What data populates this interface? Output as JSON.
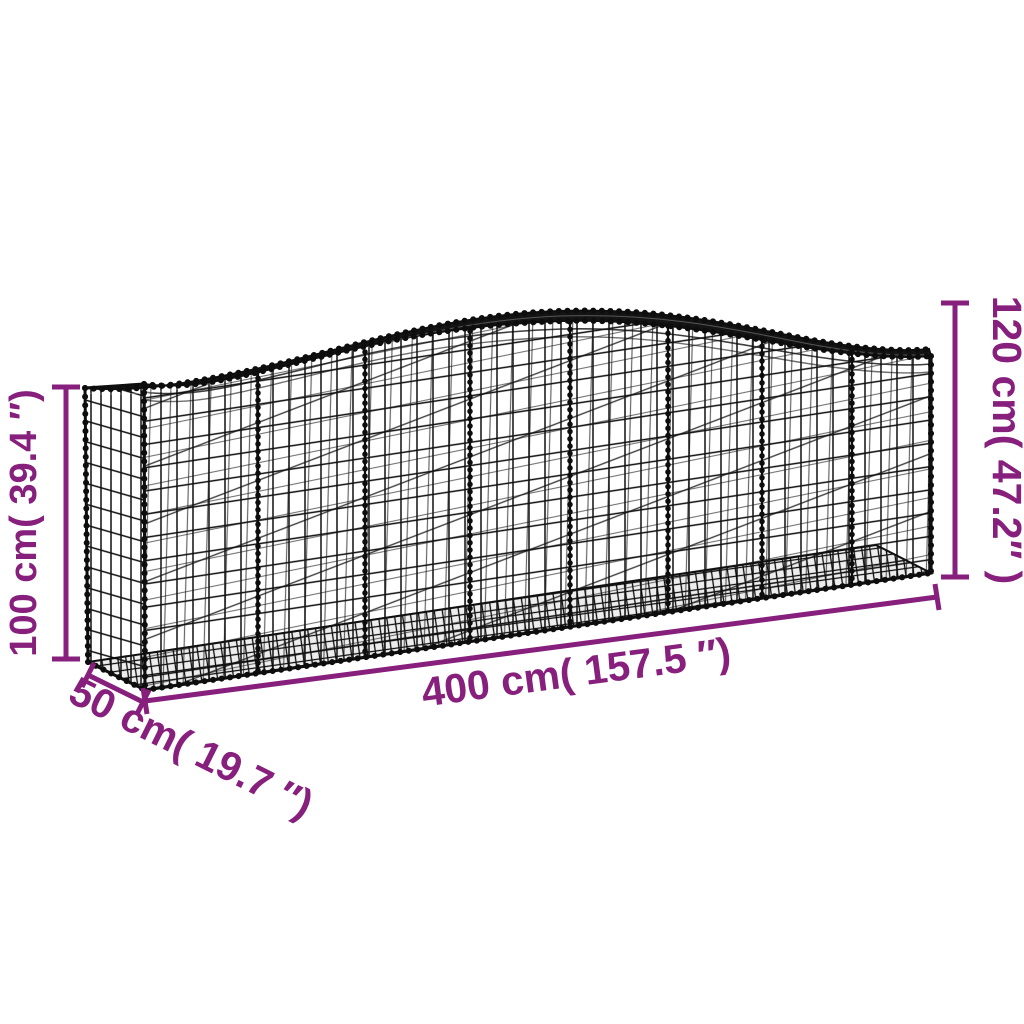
{
  "diagram": {
    "title": "Arched gabion basket dimension diagram",
    "accent_color": "#871f7c",
    "wire_color": "#0f0f0f",
    "background_color": "#ffffff",
    "labels": {
      "height_left": "100 cm( 39.4 ″)",
      "height_right": "120 cm( 47.2″ )",
      "length": "400 cm( 157.5 ″)",
      "depth": "50 cm( 19.7 ″)"
    }
  }
}
